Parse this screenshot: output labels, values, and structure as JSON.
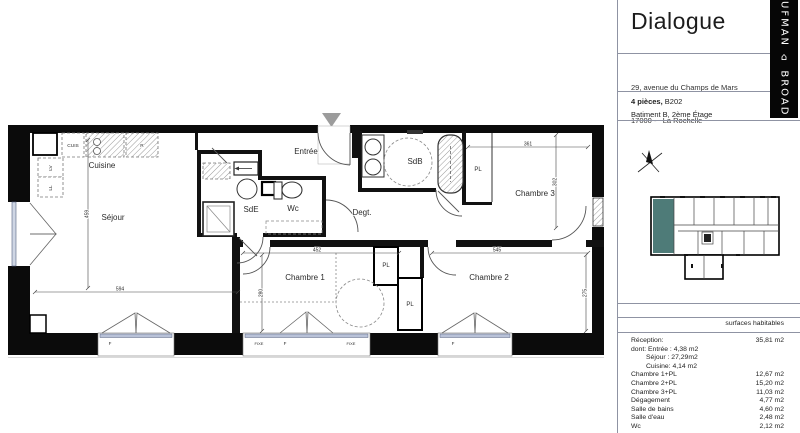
{
  "header": {
    "title": "Dialogue",
    "brand_vertical": "UFMAN ⌂ BROAD",
    "address_line1": "29, avenue du Champs de Mars",
    "address_line2": "17000 -   La Rochelle",
    "unit_type": "4 pièces,",
    "unit_number": " B202",
    "building_floor": "Batiment B, 2ème Étage"
  },
  "plan": {
    "rooms": {
      "cuisine": "Cuisine",
      "sejour": "Séjour",
      "entree": "Entrée",
      "sde": "SdE",
      "wc": "Wc",
      "degt": "Degt.",
      "sdb": "SdB",
      "chambre1": "Chambre 1",
      "chambre2": "Chambre 2",
      "chambre3": "Chambre 3",
      "pl": "PL"
    },
    "fixtures": {
      "cuis": "CUIS",
      "r": "R",
      "lv": "LV",
      "ll": "LL"
    },
    "dims": {
      "sejour_w": "594",
      "sejour_h": "459",
      "ch1_w": "452",
      "ch1_h": "280",
      "ch2_w": "545",
      "ch2_h": "275",
      "ch3_w": "361",
      "ch3_h": "302"
    },
    "windows": {
      "f": "F",
      "fixe": "FIXE"
    }
  },
  "surface_table": {
    "header": "surfaces habitables",
    "rows": [
      {
        "label": "Réception:",
        "value": "35,81 m2",
        "indent": 0
      },
      {
        "label": "dont: Entrée : 4,38 m2",
        "value": "",
        "indent": 0
      },
      {
        "label": "Séjour : 27,29m2",
        "value": "",
        "indent": 1
      },
      {
        "label": "Cuisine: 4,14 m2",
        "value": "",
        "indent": 1
      },
      {
        "label": "Chambre 1+PL",
        "value": "12,67 m2",
        "indent": 0
      },
      {
        "label": "Chambre 2+PL",
        "value": "15,20 m2",
        "indent": 0
      },
      {
        "label": "Chambre 3+PL",
        "value": "11,03 m2",
        "indent": 0
      },
      {
        "label": "Dégagement",
        "value": "4,77 m2",
        "indent": 0
      },
      {
        "label": "Salle de bains",
        "value": "4,60 m2",
        "indent": 0
      },
      {
        "label": "Salle d'eau",
        "value": "2,48 m2",
        "indent": 0
      },
      {
        "label": "Wc",
        "value": "2,12 m2",
        "indent": 0
      }
    ]
  },
  "colors": {
    "wall": "#0b0b0b",
    "highlight_teal": "#4e7b78",
    "window_glass": "#b9c2d8",
    "entrance_marker": "#9c9c9c",
    "window_label_blue": "#5b6bb5"
  }
}
